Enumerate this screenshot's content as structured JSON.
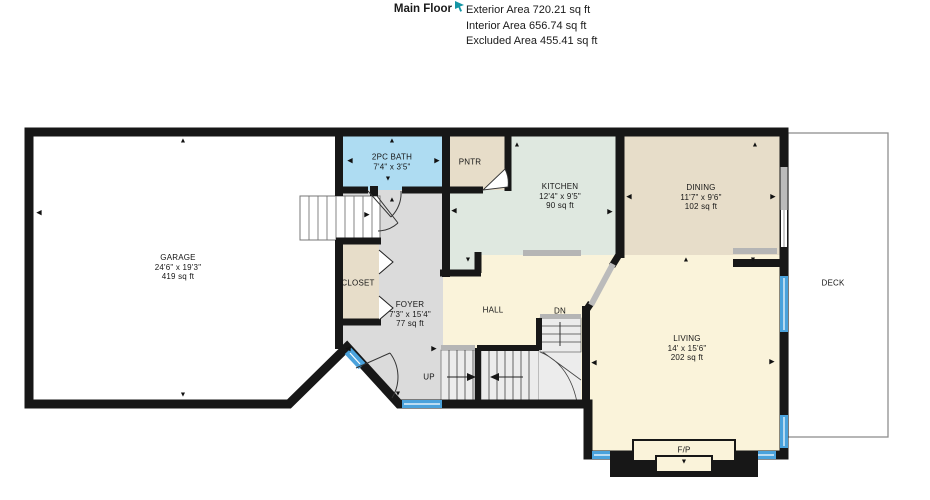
{
  "header": {
    "title": "Main Floor",
    "stats": [
      {
        "label": "Exterior Area",
        "value": "720.21 sq ft"
      },
      {
        "label": "Interior Area",
        "value": "656.74 sq ft"
      },
      {
        "label": "Excluded Area",
        "value": "455.41 sq ft"
      }
    ],
    "cursor_icon": "cursor-icon",
    "cursor_color": "#1596a5"
  },
  "plan": {
    "rooms": [
      {
        "id": "garage",
        "name": "GARAGE",
        "dims": "24'6\" x 19'3\"",
        "area": "419 sq ft",
        "cx": 178,
        "cy": 267
      },
      {
        "id": "bath",
        "name": "2PC BATH",
        "dims": "7'4\" x 3'5\"",
        "area": "",
        "cx": 392,
        "cy": 162
      },
      {
        "id": "pantry",
        "name": "PNTR",
        "dims": "",
        "area": "",
        "cx": 470,
        "cy": 162
      },
      {
        "id": "kitchen",
        "name": "KITCHEN",
        "dims": "12'4\" x 9'5\"",
        "area": "90 sq ft",
        "cx": 560,
        "cy": 196
      },
      {
        "id": "dining",
        "name": "DINING",
        "dims": "11'7\" x 9'6\"",
        "area": "102 sq ft",
        "cx": 701,
        "cy": 197
      },
      {
        "id": "closet",
        "name": "CLOSET",
        "dims": "",
        "area": "",
        "cx": 358,
        "cy": 283
      },
      {
        "id": "foyer",
        "name": "FOYER",
        "dims": "7'3\" x 15'4\"",
        "area": "77 sq ft",
        "cx": 410,
        "cy": 314
      },
      {
        "id": "hall",
        "name": "HALL",
        "dims": "",
        "area": "",
        "cx": 493,
        "cy": 310
      },
      {
        "id": "stairs-dn",
        "name": "DN",
        "dims": "",
        "area": "",
        "cx": 560,
        "cy": 311
      },
      {
        "id": "stairs-up",
        "name": "UP",
        "dims": "",
        "area": "",
        "cx": 429,
        "cy": 377
      },
      {
        "id": "living",
        "name": "LIVING",
        "dims": "14' x 15'6\"",
        "area": "202 sq ft",
        "cx": 687,
        "cy": 348
      },
      {
        "id": "deck",
        "name": "DECK",
        "dims": "",
        "area": "",
        "cx": 833,
        "cy": 283
      },
      {
        "id": "fireplace",
        "name": "F/P",
        "dims": "",
        "area": "",
        "cx": 684,
        "cy": 450
      }
    ],
    "arrows": [
      {
        "x": 183,
        "y": 141,
        "d": "up"
      },
      {
        "x": 183,
        "y": 395,
        "d": "down"
      },
      {
        "x": 39,
        "y": 213,
        "d": "left"
      },
      {
        "x": 350,
        "y": 161,
        "d": "left"
      },
      {
        "x": 437,
        "y": 161,
        "d": "right"
      },
      {
        "x": 392,
        "y": 141,
        "d": "up"
      },
      {
        "x": 388,
        "y": 179,
        "d": "down"
      },
      {
        "x": 392,
        "y": 200,
        "d": "up"
      },
      {
        "x": 517,
        "y": 145,
        "d": "up"
      },
      {
        "x": 454,
        "y": 211,
        "d": "left"
      },
      {
        "x": 610,
        "y": 212,
        "d": "right"
      },
      {
        "x": 468,
        "y": 260,
        "d": "down"
      },
      {
        "x": 755,
        "y": 145,
        "d": "up"
      },
      {
        "x": 629,
        "y": 197,
        "d": "left"
      },
      {
        "x": 773,
        "y": 197,
        "d": "right"
      },
      {
        "x": 753,
        "y": 260,
        "d": "down"
      },
      {
        "x": 686,
        "y": 260,
        "d": "up"
      },
      {
        "x": 594,
        "y": 363,
        "d": "left"
      },
      {
        "x": 772,
        "y": 362,
        "d": "right"
      },
      {
        "x": 367,
        "y": 215,
        "d": "right"
      },
      {
        "x": 348,
        "y": 349,
        "d": "left"
      },
      {
        "x": 434,
        "y": 349,
        "d": "right"
      },
      {
        "x": 398,
        "y": 394,
        "d": "down"
      },
      {
        "x": 684,
        "y": 462,
        "d": "down"
      }
    ],
    "colors": {
      "garage": "#ffffff",
      "bath": "#aedcf2",
      "pantry": "#e7ddc9",
      "kitchen": "#dfe8e0",
      "dining": "#e7ddc9",
      "closet": "#e7ddc9",
      "foyer": "#dbdbdb",
      "hall_living": "#faf3da",
      "stairs": "#ececec",
      "wall": "#171717",
      "window": "#4aa2dc",
      "cased_opening": "#b5b5b5",
      "deck_border": "#8f8f8f",
      "fireplace_box": "#faf3da"
    }
  }
}
